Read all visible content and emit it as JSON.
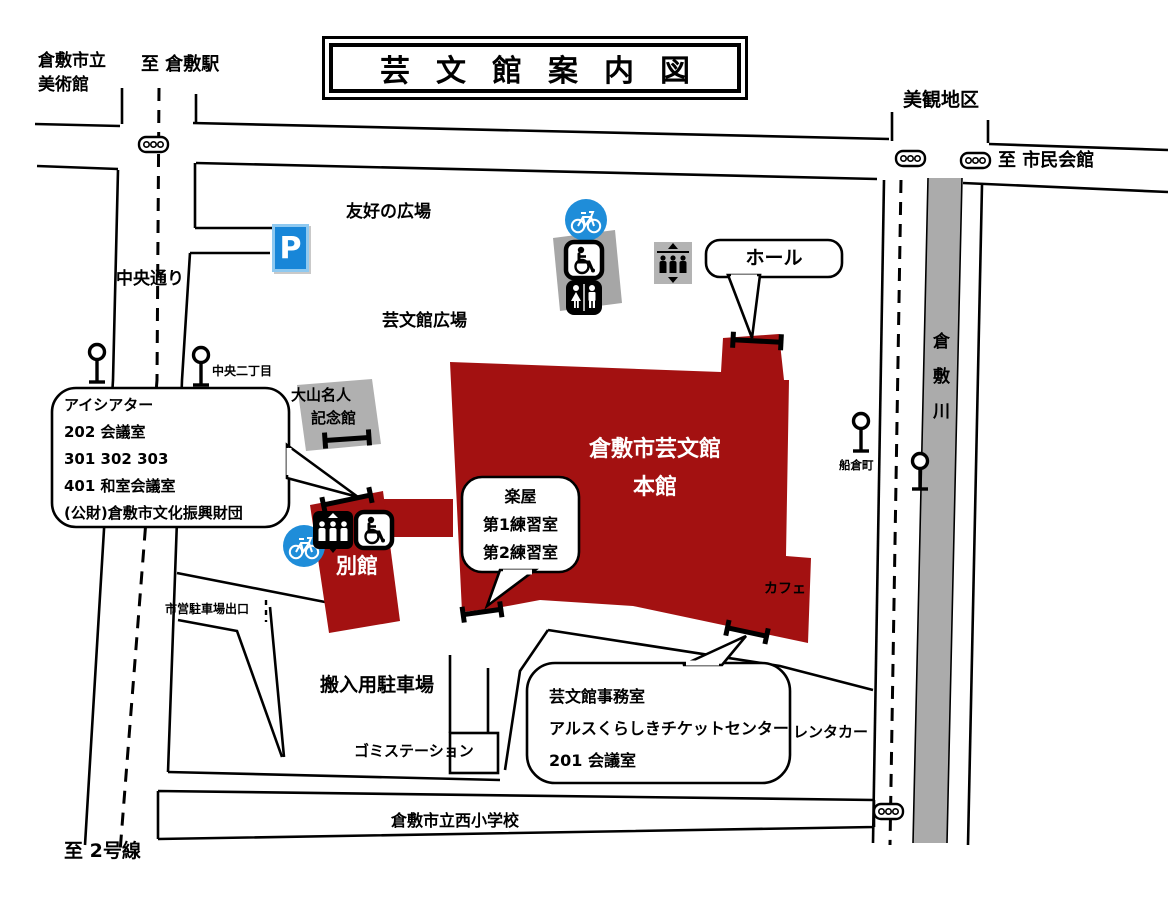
{
  "title": "芸文館案内図",
  "colors": {
    "building_red": "#A31111",
    "river_gray": "#ABABAB",
    "shadow_gray": "#A6A6A6",
    "icon_blue": "#1F8DD9",
    "parking_blue": "#1886D8",
    "parking_border": "#8FC9F0",
    "line_black": "#000000"
  },
  "places": {
    "art_museum_line1": "倉敷市立",
    "art_museum_line2": "美術館",
    "to_kurashiki_station": "至 倉敷駅",
    "bikan_district": "美観地区",
    "to_civic_hall": "至 市民会館",
    "friendship_plaza": "友好の広場",
    "chuo_street": "中央通り",
    "geibunkan_plaza": "芸文館広場",
    "chuo_2chome": "中央二丁目",
    "oyama_meijin_line1": "大山名人",
    "oyama_meijin_line2": "記念館",
    "funakura_cho": "船倉町",
    "kurashiki_river": "倉敷川",
    "main_building_line1": "倉敷市芸文館",
    "main_building_line2": "本館",
    "annex": "別館",
    "cafe": "カフェ",
    "city_parking_exit": "市営駐車場出口",
    "loading_parking": "搬入用駐車場",
    "garbage_station": "ゴミステーション",
    "rent_a_car": "レンタカー",
    "nishi_elementary": "倉敷市立西小学校",
    "to_route2": "至 2号線",
    "parking_sign": "P"
  },
  "callouts": {
    "hall": {
      "label": "ホール"
    },
    "i_theater": {
      "lines": [
        "アイシアター",
        "202 会議室",
        "301 302 303",
        "401 和室会議室",
        "(公財)倉敷市文化振興財団"
      ]
    },
    "rehearsal": {
      "lines": [
        "楽屋",
        "第1練習室",
        "第2練習室"
      ]
    },
    "office": {
      "lines": [
        "芸文館事務室",
        "アルスくらしきチケットセンター",
        "201 会議室"
      ]
    }
  },
  "icons": {
    "bicycle": "white-bicycle-in-blue-circle",
    "wheelchair": "wheelchair-symbol-square",
    "restroom": "male-female-figures-square",
    "elevator": "three-figures-with-up-down-arrows",
    "parking": "blue-P-sign",
    "traffic_light": "rounded-box-three-circles",
    "street_lamp": "circle-on-pole",
    "entrance": "i-beam-entrance-mark"
  }
}
